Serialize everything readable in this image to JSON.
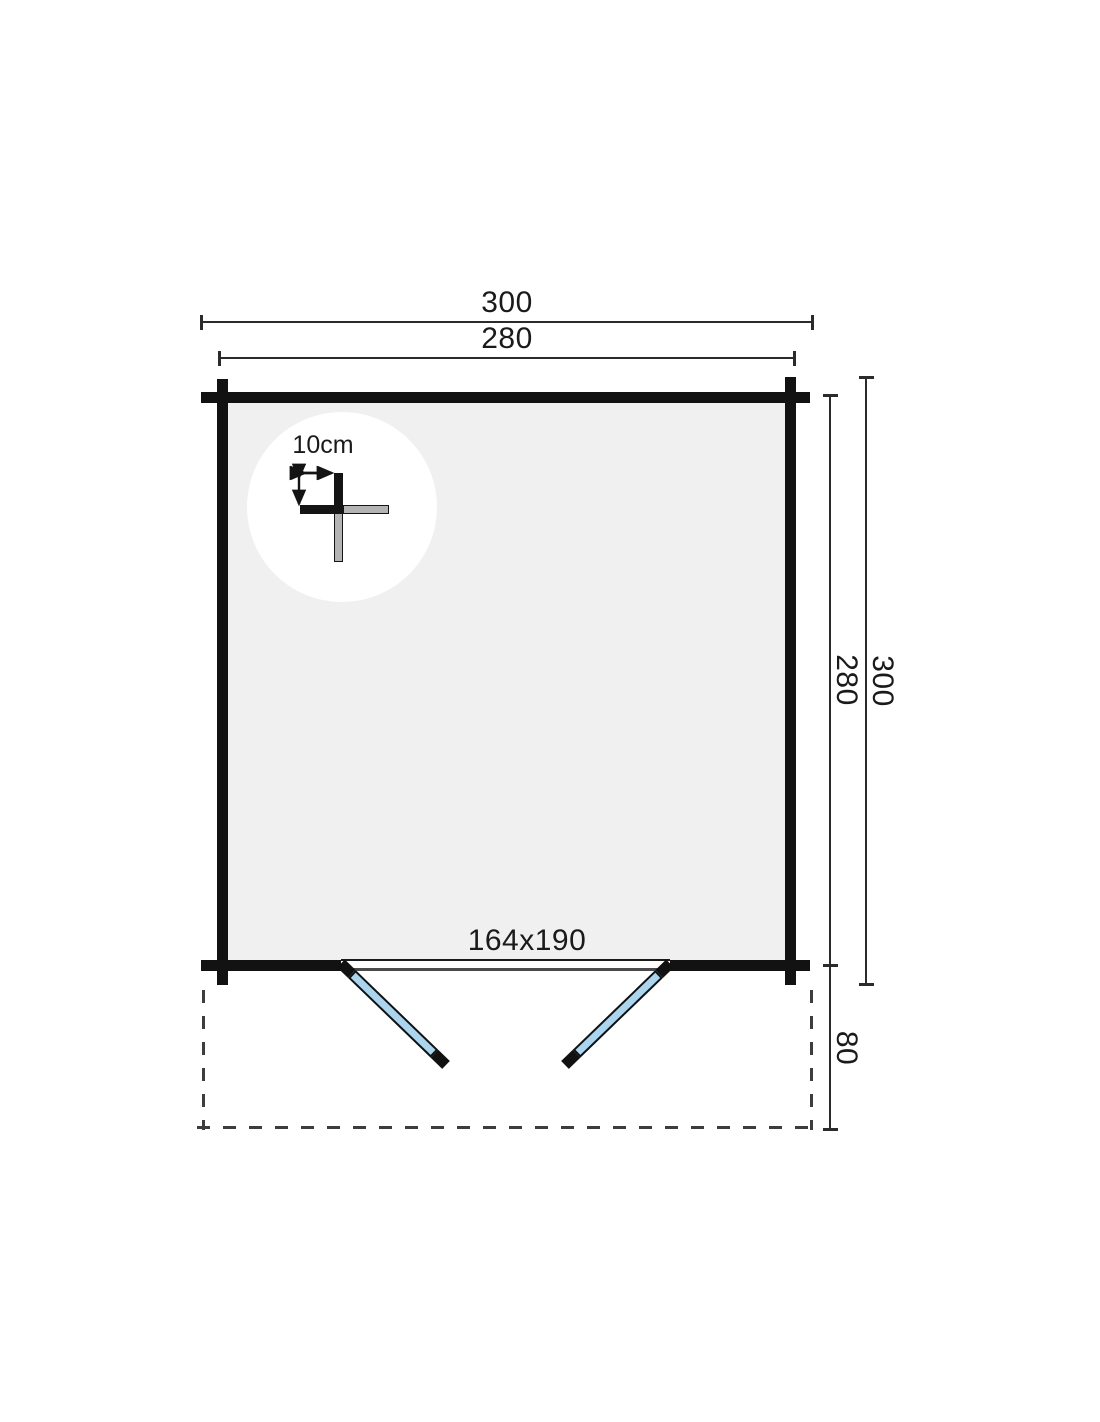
{
  "diagram": {
    "type": "log-cabin-floor-plan",
    "labels": {
      "width_outer": "300",
      "width_inner": "280",
      "height_outer": "300",
      "height_inner": "280",
      "canopy_depth": "80",
      "door_size": "164x190",
      "wall_thickness": "10cm"
    },
    "colors": {
      "background": "#ffffff",
      "floor": "#f0f0f0",
      "wall": "#121212",
      "dimension_line": "#2b2b2b",
      "door_glass": "#abd5ef",
      "detail_gray": "#b4b4b4"
    }
  }
}
